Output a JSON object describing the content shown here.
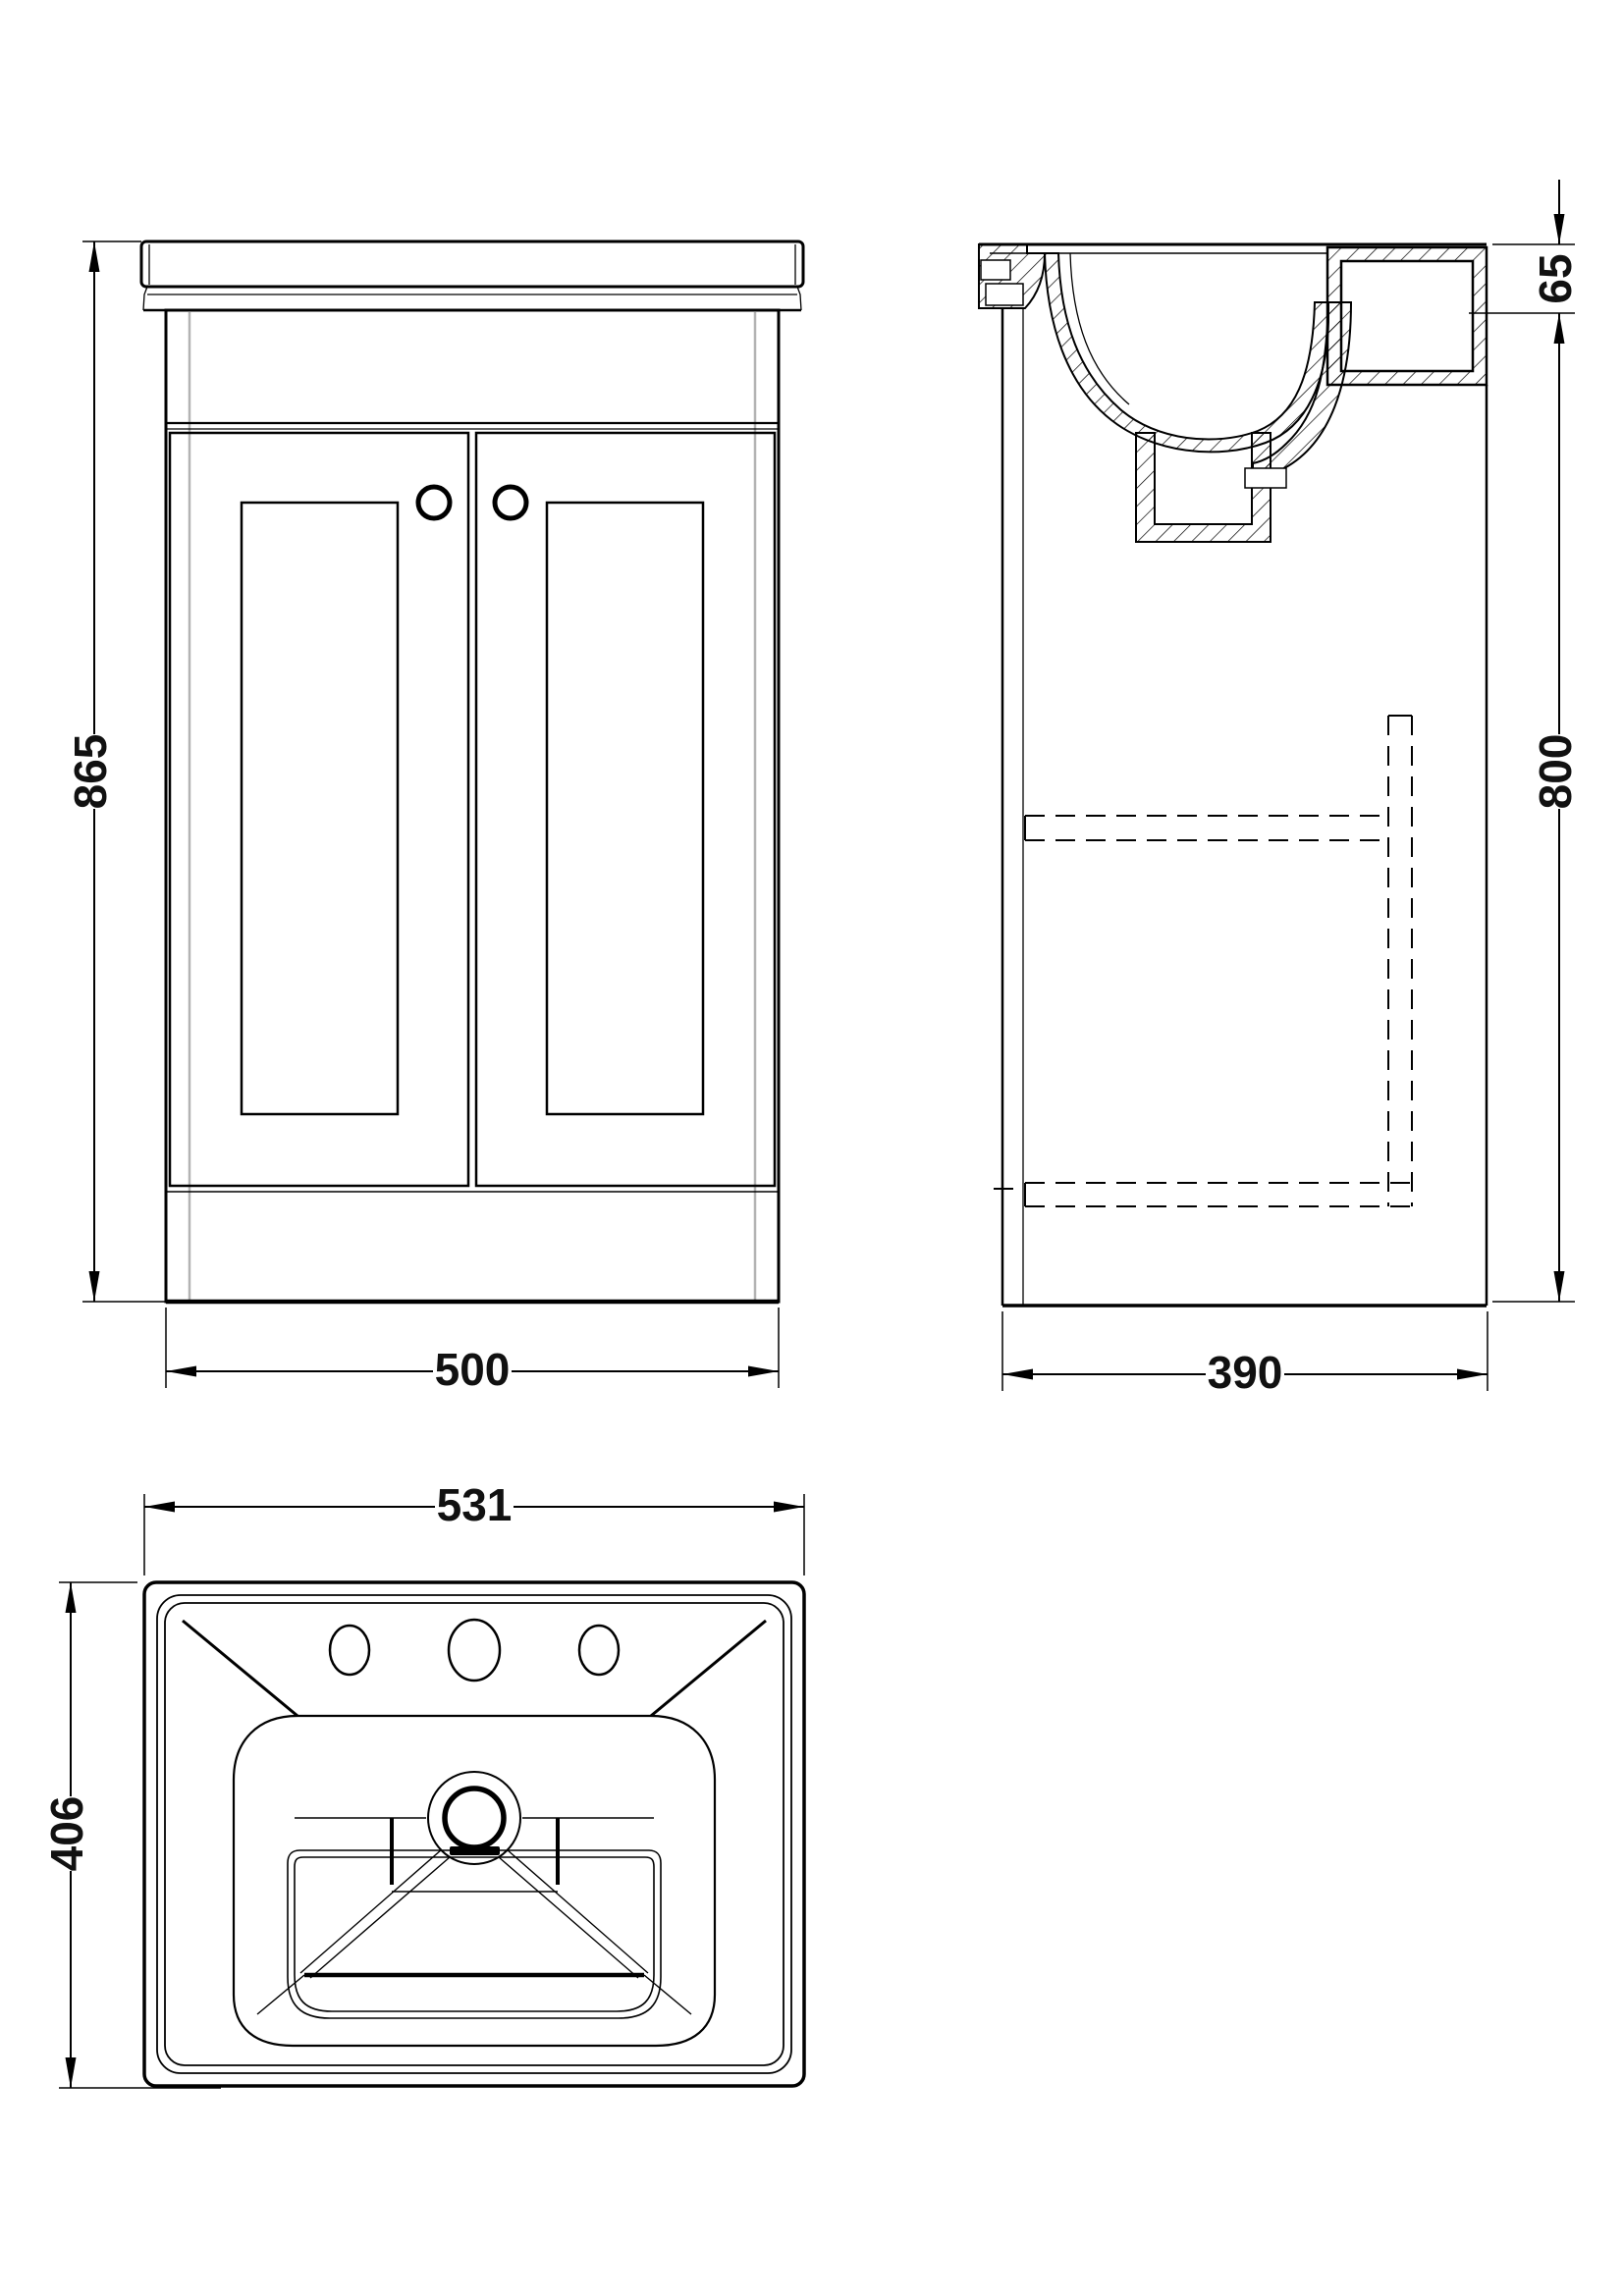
{
  "meta": {
    "drawing_title": "vanity-unit-with-basin-technical-drawing",
    "background": "#ffffff",
    "line_color": "#000000",
    "carcass_line_color": "#b3b3b3"
  },
  "views": {
    "front": {
      "name": "front-elevation",
      "height_mm": {
        "value": "865"
      },
      "width_mm": {
        "value": "500"
      }
    },
    "side": {
      "name": "side-section",
      "basin_height_mm": {
        "value": "65"
      },
      "cabinet_height_mm": {
        "value": "800"
      },
      "depth_mm": {
        "value": "390"
      }
    },
    "plan": {
      "name": "basin-plan",
      "width_mm": {
        "value": "531"
      },
      "depth_mm": {
        "value": "406"
      }
    }
  }
}
